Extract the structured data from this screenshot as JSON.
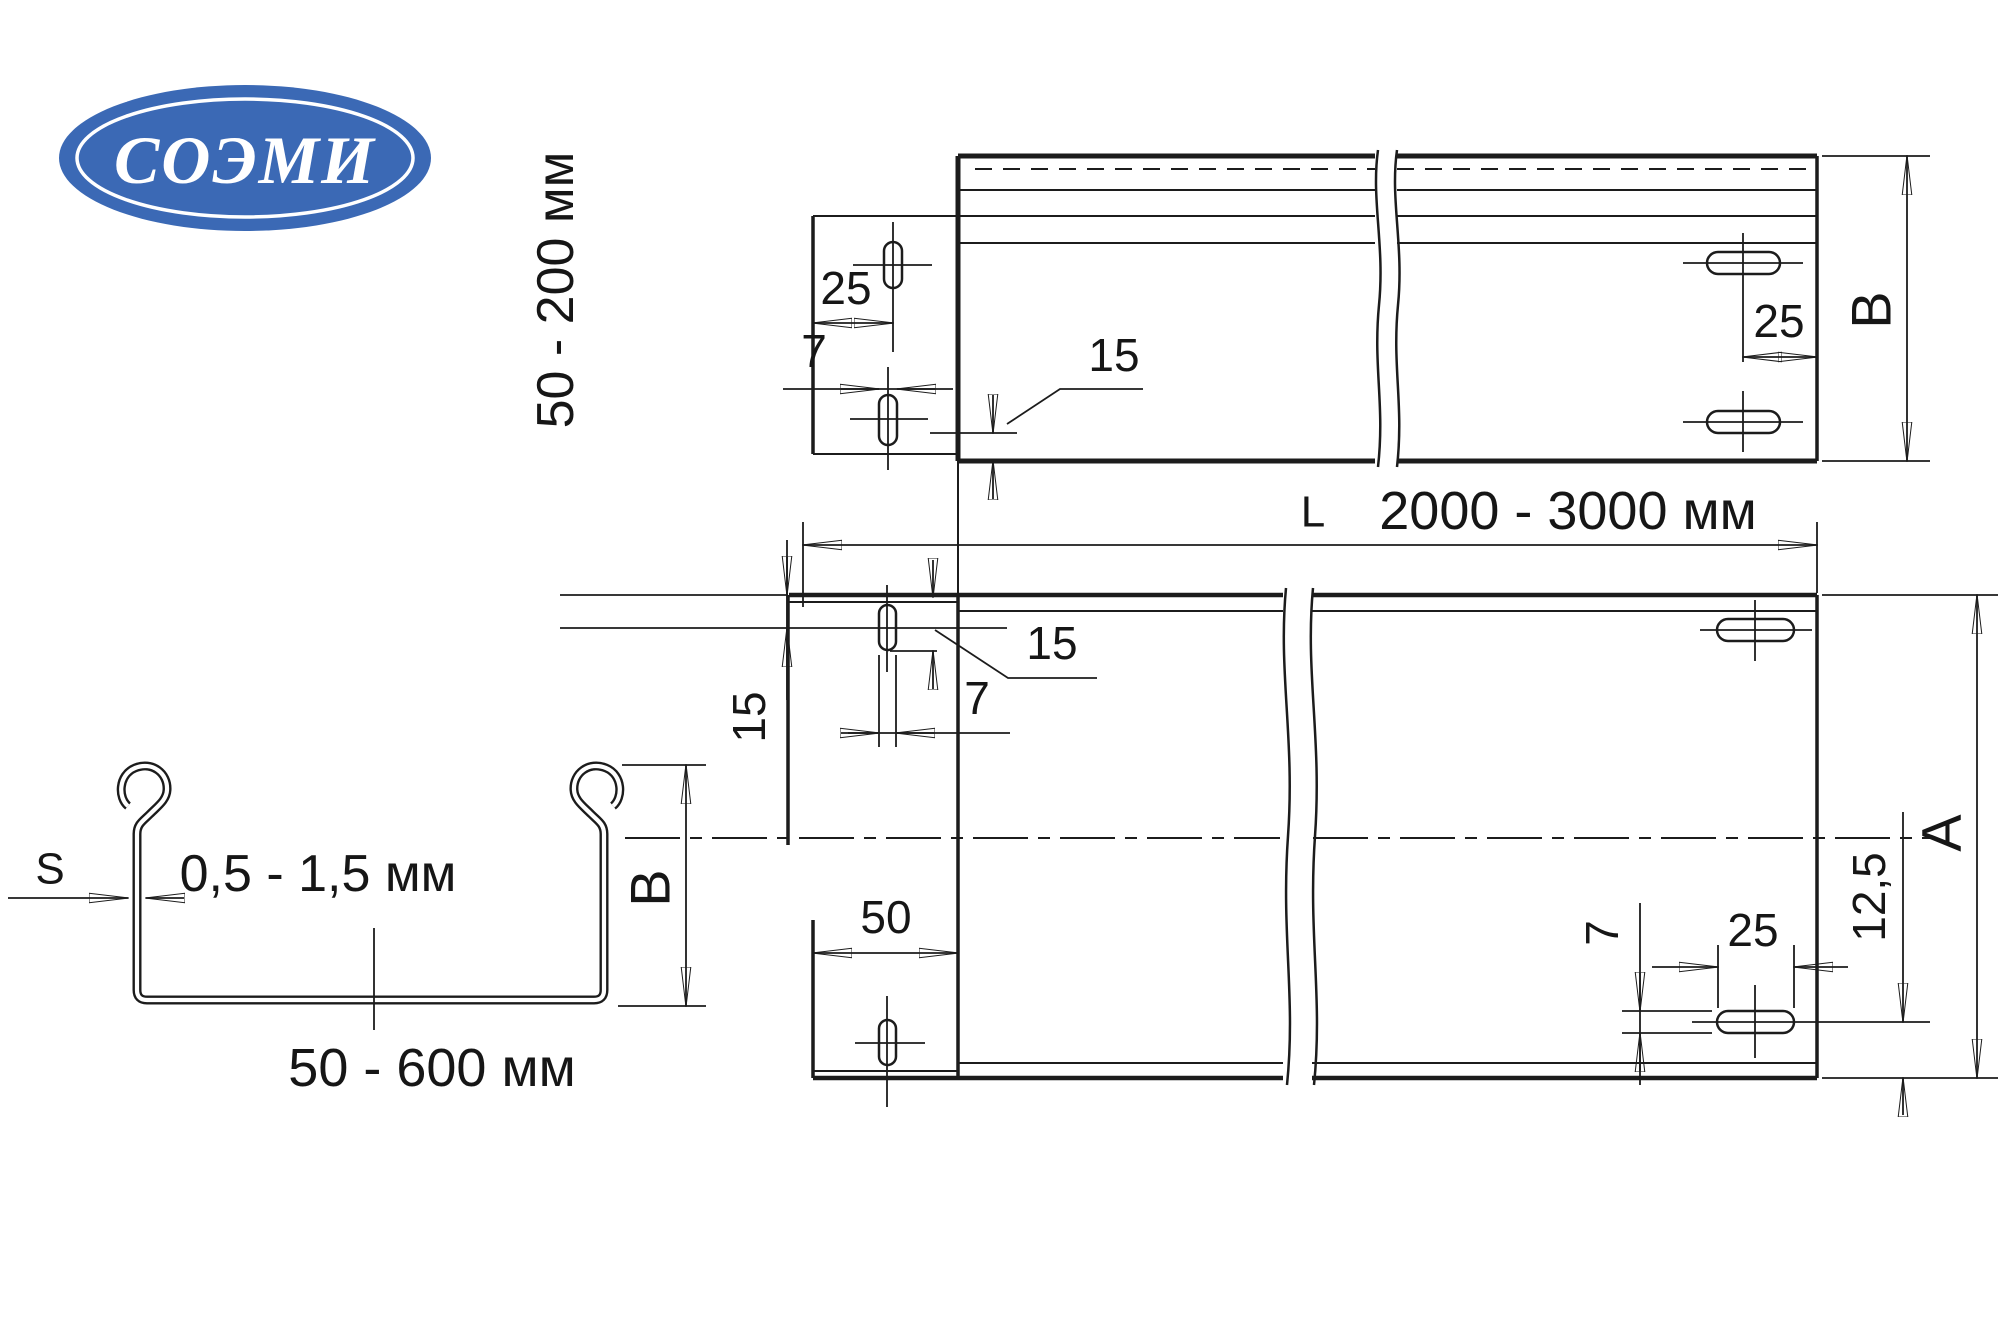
{
  "logo": {
    "text": "СОЭМИ",
    "bg_color": "#3b69b5",
    "ring_color": "#ffffff",
    "text_color": "#ffffff"
  },
  "colors": {
    "line": "#1c1c1c",
    "background": "#ffffff"
  },
  "side_view": {
    "height_range_label": "50 - 200 мм",
    "dim_slot_offset": "25",
    "dim_slot_width": "7",
    "dim_leader": "15",
    "dim_end_slot": "25",
    "width_letter": "B"
  },
  "length_dim": {
    "letter": "L",
    "value": "2000 - 3000 мм"
  },
  "plan_view": {
    "dim_row_offset": "15",
    "dim_leader": "15",
    "dim_slot_width": "7",
    "dim_tab_length": "50",
    "dim_end_slot_height": "7",
    "dim_end_slot_length": "25",
    "dim_edge_offset": "12,5",
    "width_letter": "A"
  },
  "cross_section": {
    "thickness_letter": "S",
    "thickness_range": "0,5 - 1,5 мм",
    "height_letter": "B",
    "width_range": "50 - 600 мм"
  }
}
